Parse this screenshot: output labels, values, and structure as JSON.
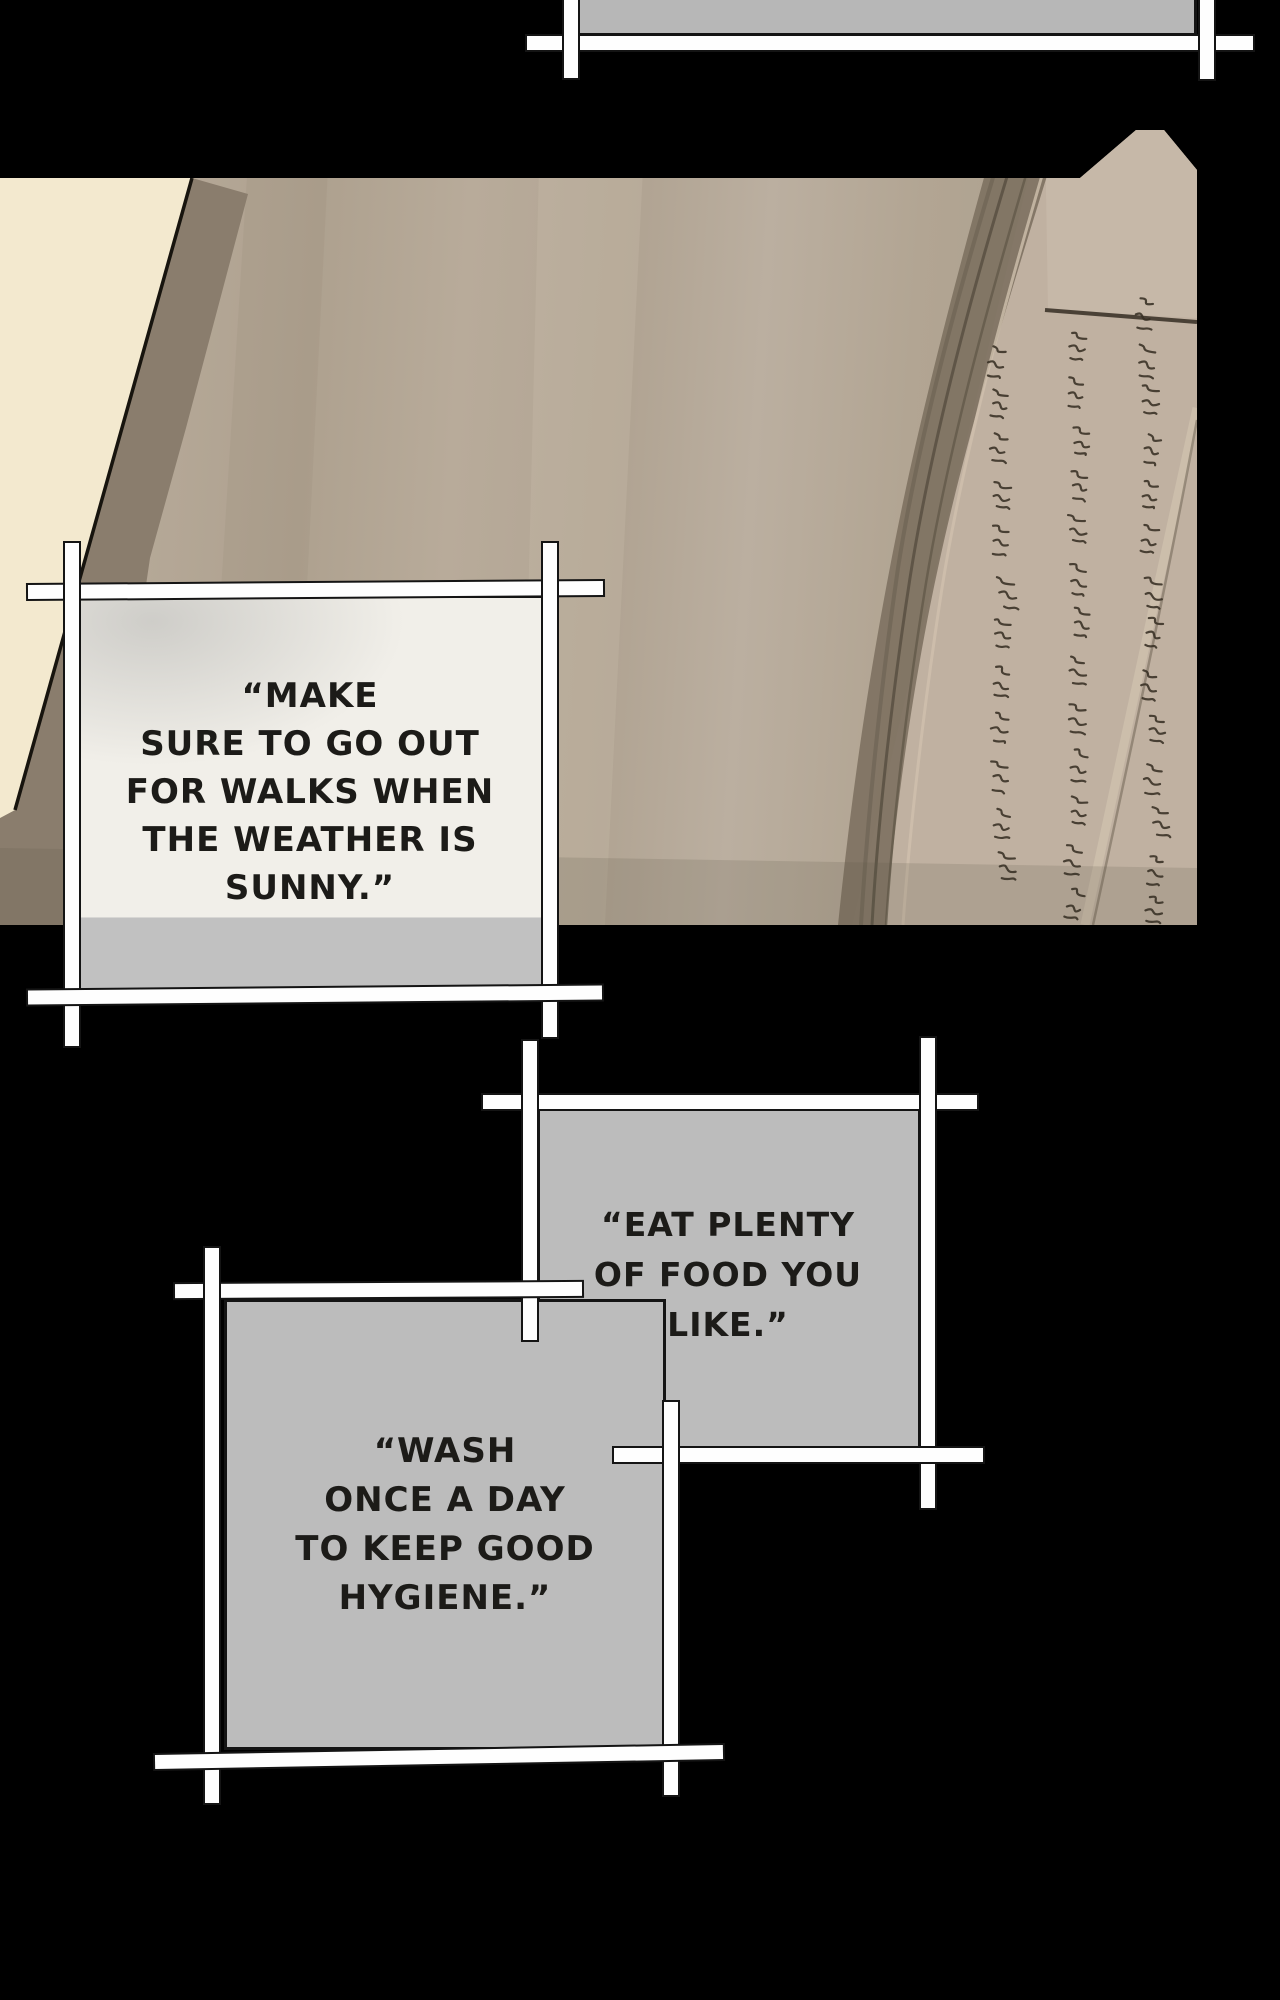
{
  "page": {
    "width": 1280,
    "height": 2000,
    "background": "#000000"
  },
  "top_panel": {
    "fill": "#b7b7b7"
  },
  "photo_panel": {
    "page_tan": "#b2a594",
    "page_cream": "#f3e9cf",
    "spine_shadow": "#7d7161",
    "right_page": "#c0b1a1",
    "ink": "#372f23"
  },
  "captions": [
    {
      "id": "caption-1",
      "bg": "#f1efe9",
      "bottom_strip": "#c1c1c1",
      "text": "“MAKE\nSURE TO GO OUT\nFOR WALKS WHEN\nTHE WEATHER IS\nSUNNY.”"
    },
    {
      "id": "caption-2",
      "bg": "#bcbcbc",
      "text": "“EAT PLENTY\nOF FOOD YOU\nLIKE.”"
    },
    {
      "id": "caption-3",
      "bg": "#bcbcbc",
      "text": "“WASH\nONCE A DAY\nTO KEEP GOOD\nHYGIENE.”"
    }
  ],
  "frame": {
    "line_color": "#fefefe",
    "outline_color": "#141414",
    "text_color": "#1c1b18"
  }
}
